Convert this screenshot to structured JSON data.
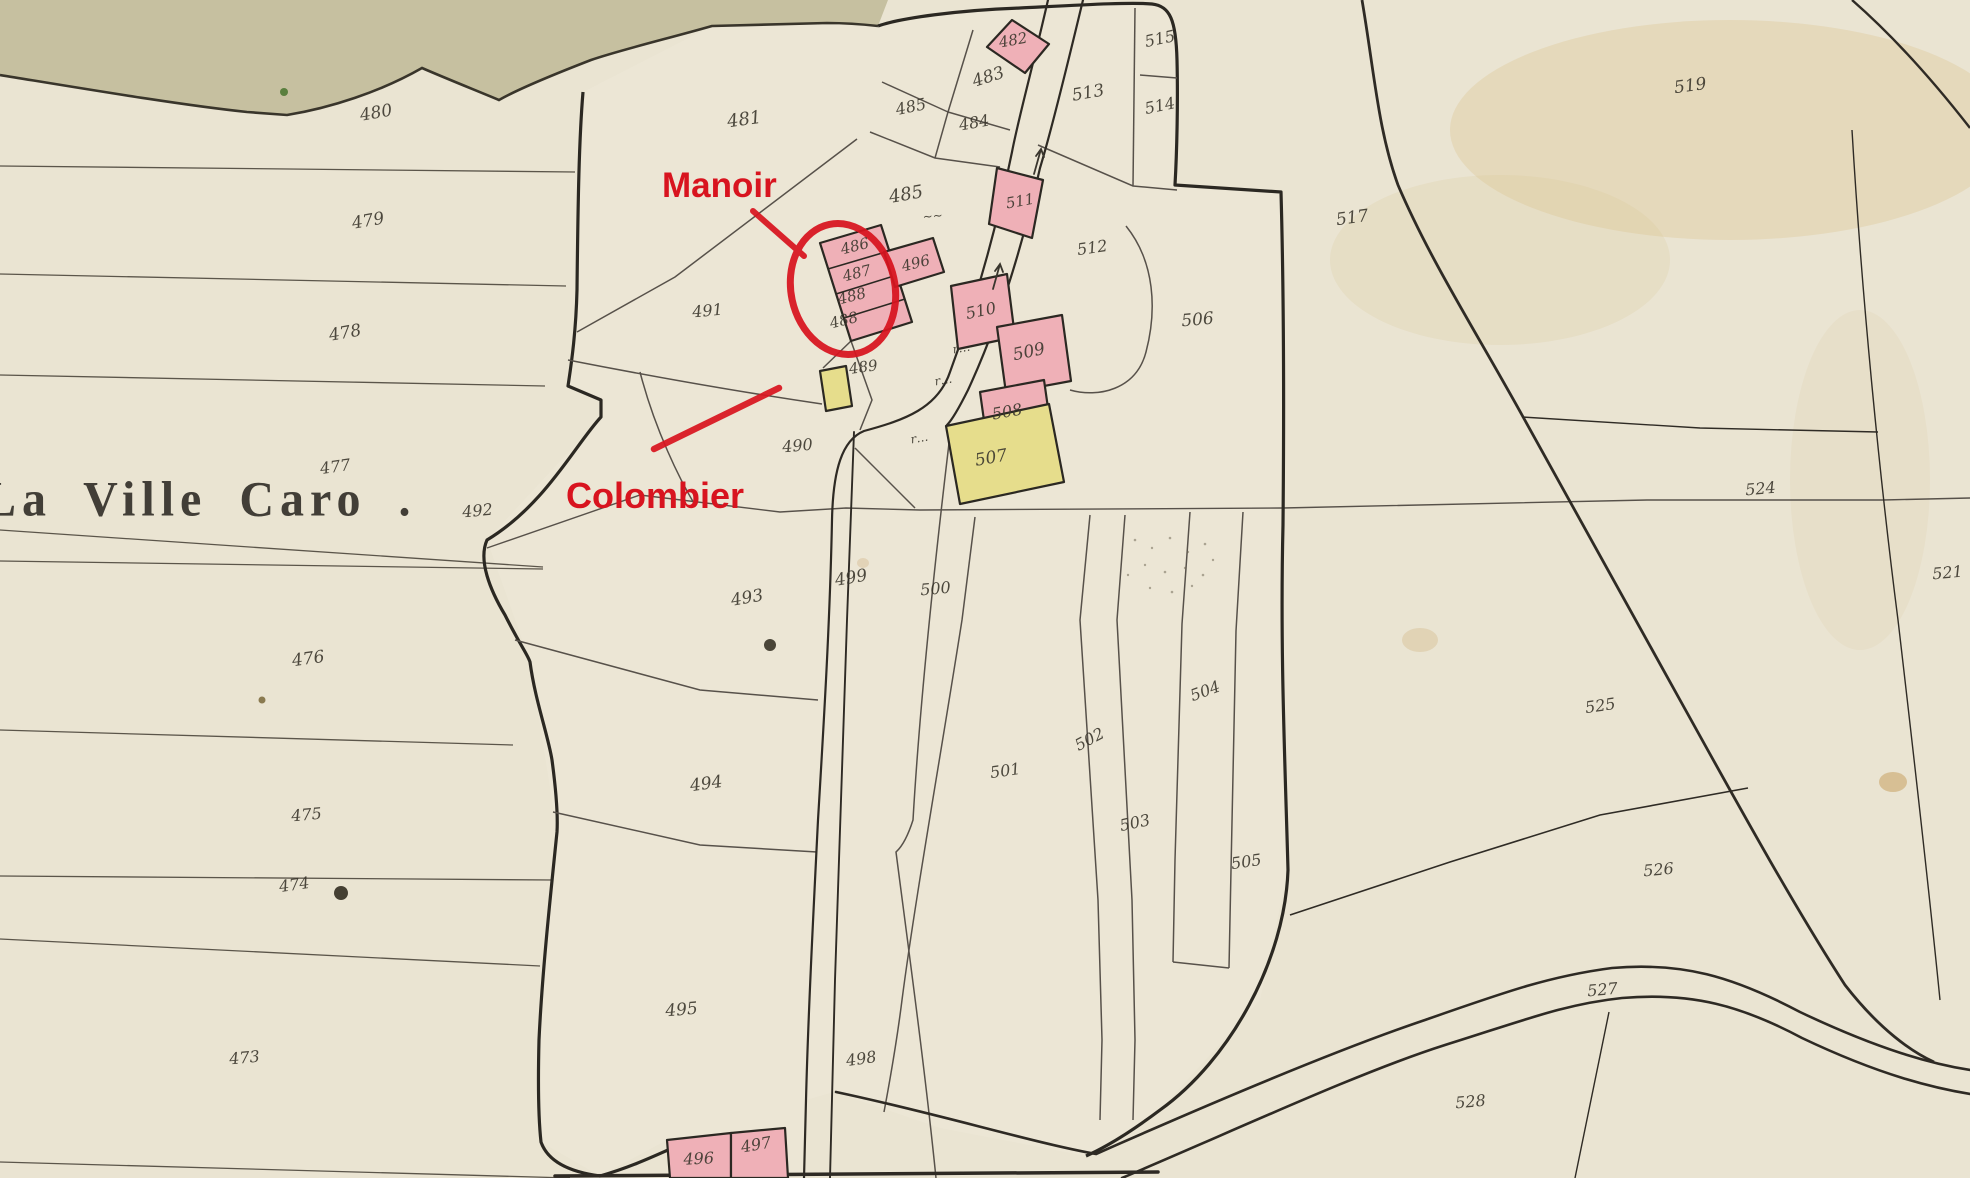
{
  "map": {
    "place_label": "La Ville Caro .",
    "annotations": [
      {
        "id": "manoir",
        "text": "Manoir"
      },
      {
        "id": "colombier",
        "text": "Colombier"
      }
    ],
    "colors": {
      "paper": "#eae4d2",
      "top_band": "#c6c0a0",
      "building_pink": "#efb0b7",
      "building_yellow": "#e6dd8c",
      "annotation_red": "#d8141f",
      "ink": "#3b372d",
      "parcel_line": "#5b554a",
      "outline": "#2b2822"
    },
    "labels": [
      {
        "t": "480",
        "x": 377,
        "y": 118,
        "s": 17,
        "r": -10
      },
      {
        "t": "479",
        "x": 369,
        "y": 226,
        "s": 17,
        "r": -10
      },
      {
        "t": "478",
        "x": 346,
        "y": 338,
        "s": 17,
        "r": -10
      },
      {
        "t": "477",
        "x": 336,
        "y": 472,
        "s": 16,
        "r": -8
      },
      {
        "t": "476",
        "x": 309,
        "y": 664,
        "s": 17,
        "r": -8
      },
      {
        "t": "475",
        "x": 307,
        "y": 820,
        "s": 16,
        "r": -5
      },
      {
        "t": "474",
        "x": 295,
        "y": 890,
        "s": 16,
        "r": -8
      },
      {
        "t": "473",
        "x": 245,
        "y": 1063,
        "s": 16,
        "r": -5
      },
      {
        "t": "481",
        "x": 745,
        "y": 125,
        "s": 18,
        "r": -8
      },
      {
        "t": "482",
        "x": 1014,
        "y": 45,
        "s": 15,
        "r": -10
      },
      {
        "t": "483",
        "x": 990,
        "y": 82,
        "s": 17,
        "r": -18
      },
      {
        "t": "485",
        "x": 912,
        "y": 112,
        "s": 16,
        "r": -12
      },
      {
        "t": "484",
        "x": 975,
        "y": 128,
        "s": 16,
        "r": -10
      },
      {
        "t": "485",
        "x": 907,
        "y": 200,
        "s": 18,
        "r": -10
      },
      {
        "t": "~~",
        "x": 933,
        "y": 220,
        "s": 12,
        "r": -5
      },
      {
        "t": "486",
        "x": 856,
        "y": 251,
        "s": 15,
        "r": -14
      },
      {
        "t": "487",
        "x": 858,
        "y": 278,
        "s": 15,
        "r": -14
      },
      {
        "t": "488",
        "x": 853,
        "y": 301,
        "s": 15,
        "r": -14
      },
      {
        "t": "488",
        "x": 845,
        "y": 325,
        "s": 15,
        "r": -14
      },
      {
        "t": "496",
        "x": 917,
        "y": 268,
        "s": 15,
        "r": -14
      },
      {
        "t": "489",
        "x": 864,
        "y": 372,
        "s": 15,
        "r": -8
      },
      {
        "t": "490",
        "x": 798,
        "y": 451,
        "s": 16,
        "r": -5
      },
      {
        "t": "491",
        "x": 708,
        "y": 316,
        "s": 16,
        "r": -5
      },
      {
        "t": "492",
        "x": 478,
        "y": 516,
        "s": 16,
        "r": -5
      },
      {
        "t": "493",
        "x": 748,
        "y": 603,
        "s": 17,
        "r": -10
      },
      {
        "t": "494",
        "x": 707,
        "y": 789,
        "s": 17,
        "r": -8
      },
      {
        "t": "495",
        "x": 682,
        "y": 1015,
        "s": 17,
        "r": -5
      },
      {
        "t": "496",
        "x": 699,
        "y": 1164,
        "s": 16,
        "r": -3
      },
      {
        "t": "497",
        "x": 757,
        "y": 1150,
        "s": 16,
        "r": -10
      },
      {
        "t": "498",
        "x": 862,
        "y": 1064,
        "s": 16,
        "r": -8
      },
      {
        "t": "499",
        "x": 852,
        "y": 583,
        "s": 17,
        "r": -10
      },
      {
        "t": "500",
        "x": 936,
        "y": 594,
        "s": 16,
        "r": -5
      },
      {
        "t": "501",
        "x": 1006,
        "y": 776,
        "s": 16,
        "r": -8
      },
      {
        "t": "502",
        "x": 1092,
        "y": 744,
        "s": 16,
        "r": -28
      },
      {
        "t": "503",
        "x": 1136,
        "y": 828,
        "s": 16,
        "r": -12
      },
      {
        "t": "504",
        "x": 1207,
        "y": 696,
        "s": 16,
        "r": -20
      },
      {
        "t": "505",
        "x": 1247,
        "y": 867,
        "s": 16,
        "r": -8
      },
      {
        "t": "506",
        "x": 1198,
        "y": 325,
        "s": 17,
        "r": -5
      },
      {
        "t": "507",
        "x": 992,
        "y": 463,
        "s": 17,
        "r": -10
      },
      {
        "t": "508",
        "x": 1008,
        "y": 417,
        "s": 16,
        "r": -10
      },
      {
        "t": "509",
        "x": 1030,
        "y": 357,
        "s": 17,
        "r": -12
      },
      {
        "t": "510",
        "x": 982,
        "y": 316,
        "s": 16,
        "r": -12
      },
      {
        "t": "511",
        "x": 1021,
        "y": 206,
        "s": 15,
        "r": -10
      },
      {
        "t": "512",
        "x": 1093,
        "y": 253,
        "s": 16,
        "r": -8
      },
      {
        "t": "513",
        "x": 1089,
        "y": 98,
        "s": 17,
        "r": -10
      },
      {
        "t": "514",
        "x": 1161,
        "y": 111,
        "s": 16,
        "r": -12
      },
      {
        "t": "515",
        "x": 1161,
        "y": 44,
        "s": 16,
        "r": -12
      },
      {
        "t": "517",
        "x": 1353,
        "y": 223,
        "s": 17,
        "r": -8
      },
      {
        "t": "519",
        "x": 1691,
        "y": 91,
        "s": 17,
        "r": -8
      },
      {
        "t": "521",
        "x": 1948,
        "y": 578,
        "s": 16,
        "r": -5
      },
      {
        "t": "524",
        "x": 1761,
        "y": 494,
        "s": 16,
        "r": -5
      },
      {
        "t": "525",
        "x": 1601,
        "y": 711,
        "s": 16,
        "r": -8
      },
      {
        "t": "526",
        "x": 1659,
        "y": 875,
        "s": 16,
        "r": -5
      },
      {
        "t": "527",
        "x": 1603,
        "y": 995,
        "s": 16,
        "r": -5
      },
      {
        "t": "528",
        "x": 1471,
        "y": 1107,
        "s": 16,
        "r": -5
      },
      {
        "t": "r…",
        "x": 962,
        "y": 352,
        "s": 12,
        "r": -10
      },
      {
        "t": "r…",
        "x": 944,
        "y": 384,
        "s": 12,
        "r": -10
      },
      {
        "t": "r…",
        "x": 920,
        "y": 442,
        "s": 12,
        "r": -10
      }
    ]
  }
}
